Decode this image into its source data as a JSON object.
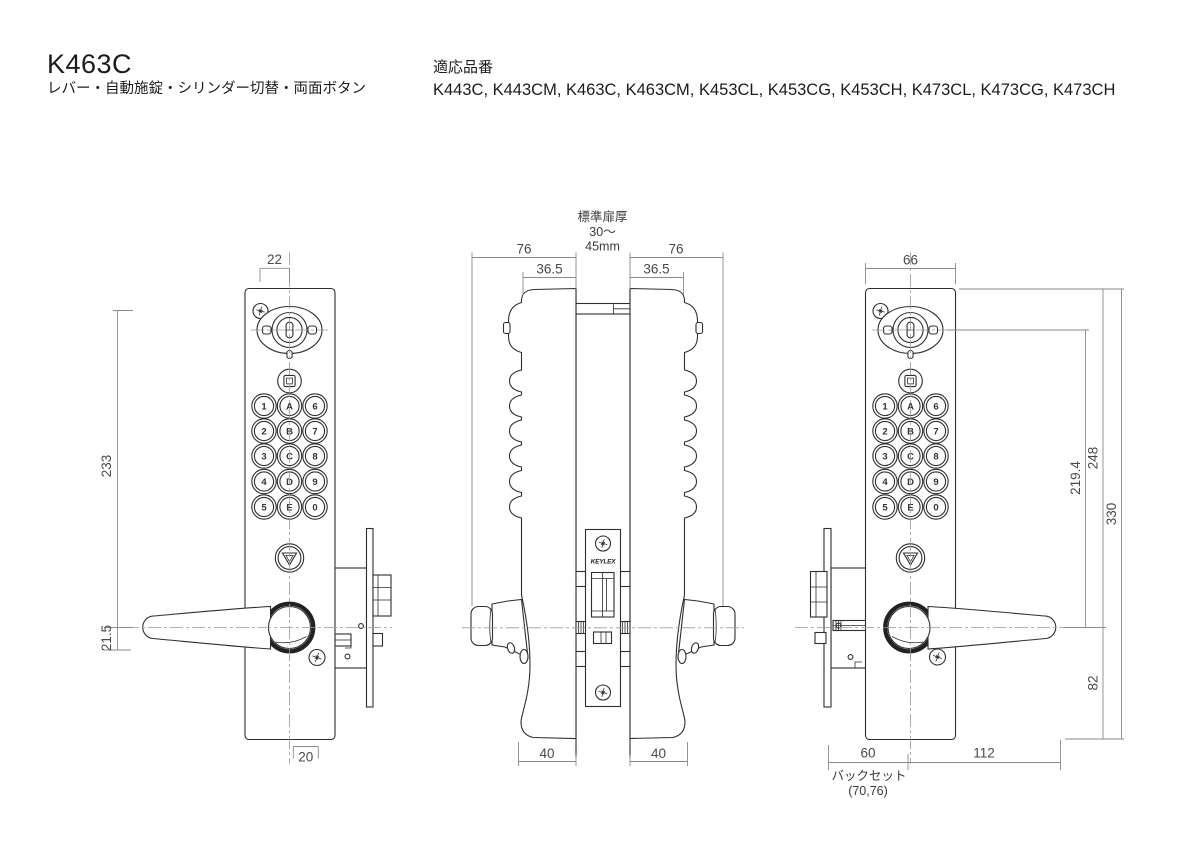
{
  "header": {
    "model": "K463C",
    "subtitle": "レバー・自動施錠・シリンダー切替・両面ボタン",
    "compat_label": "適応品番",
    "compat_models": "K443C, K443CM, K463C, K463CM, K453CL, K453CG, K453CH, K473CL, K473CG, K473CH"
  },
  "brand": {
    "logo": "KEYLEX"
  },
  "keypad": {
    "rows": [
      [
        "1",
        "A",
        "6"
      ],
      [
        "2",
        "B",
        "7"
      ],
      [
        "3",
        "C",
        "8"
      ],
      [
        "4",
        "D",
        "9"
      ],
      [
        "5",
        "E",
        "0"
      ]
    ]
  },
  "views": {
    "front_left": {
      "dims": {
        "top_offset": "22",
        "body_height": "233",
        "handle_offset": "21.5",
        "bottom_offset": "20"
      }
    },
    "side": {
      "dims": {
        "depth_left": "76",
        "depth_right": "76",
        "inner_left": "36.5",
        "inner_right": "36.5",
        "body_left": "40",
        "body_right": "40"
      },
      "door_note": {
        "line1": "標準扉厚",
        "line2": "30〜",
        "line3": "45mm"
      }
    },
    "front_right": {
      "dims": {
        "width": "66",
        "cyl_to_handle": "219.4",
        "top_to_handle": "248",
        "total_height": "330",
        "handle_to_bottom": "82",
        "backset": "60",
        "lever_length": "112"
      },
      "backset_note": {
        "label": "バックセット",
        "options": "(70,76)"
      }
    }
  },
  "colors": {
    "background": "#ffffff",
    "outline": "#2f2f2f",
    "dimension_line": "#8a8a8a",
    "centerline": "#9b9b9b",
    "text": "#1c1c1c"
  }
}
